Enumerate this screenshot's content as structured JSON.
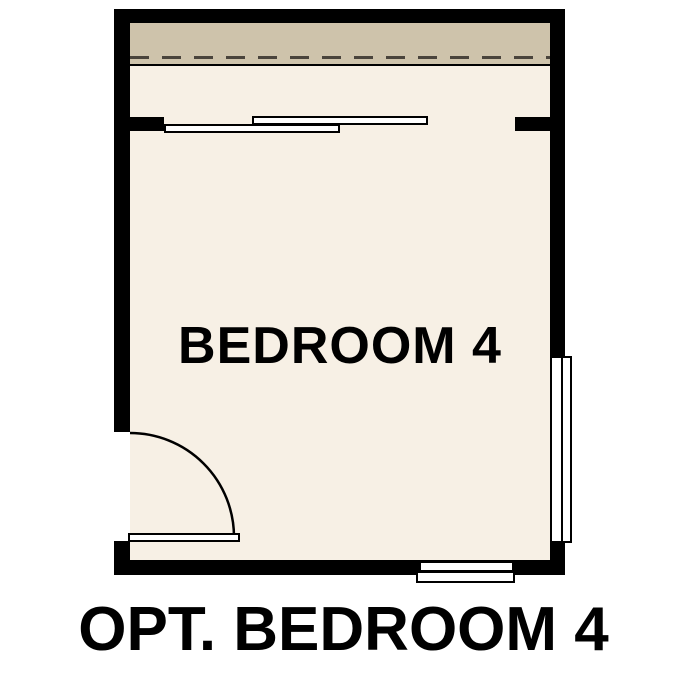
{
  "plan": {
    "room_label": "BEDROOM 4",
    "caption": "OPT. BEDROOM 4"
  },
  "colors": {
    "background": "#ffffff",
    "wall": "#000000",
    "floor": "#f7f0e5",
    "closet_strip": "#cec3ab",
    "dash": "#4a443c",
    "fixture_fill": "#ffffff",
    "text": "#000000"
  }
}
